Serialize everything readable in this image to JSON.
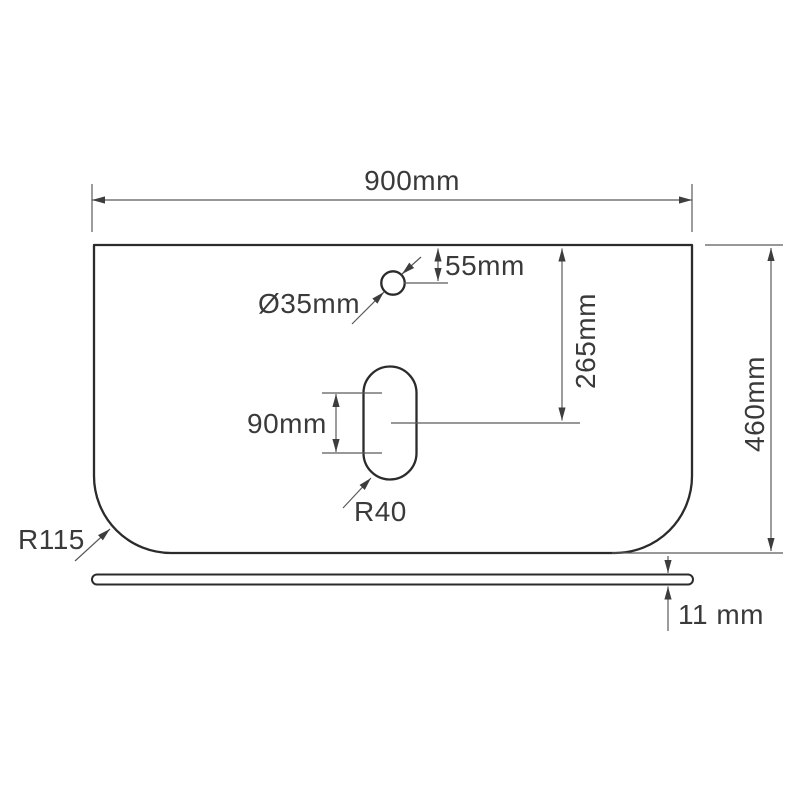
{
  "drawing": {
    "type": "technical-drawing",
    "subject": "countertop-panel-with-tap-hole-and-waste-slot",
    "labels": {
      "width": "900mm",
      "height": "460mm",
      "hole_diameter": "Ø35mm",
      "hole_offset_top": "55mm",
      "slot_center_from_top": "265mm",
      "slot_length": "90mm",
      "slot_radius": "R40",
      "corner_radius": "R115",
      "thickness": "11 mm"
    },
    "colors": {
      "outline": "#2b2b2b",
      "dimension_lines": "#5a5a5a",
      "text": "#3a3a3a",
      "background": "#ffffff"
    }
  }
}
